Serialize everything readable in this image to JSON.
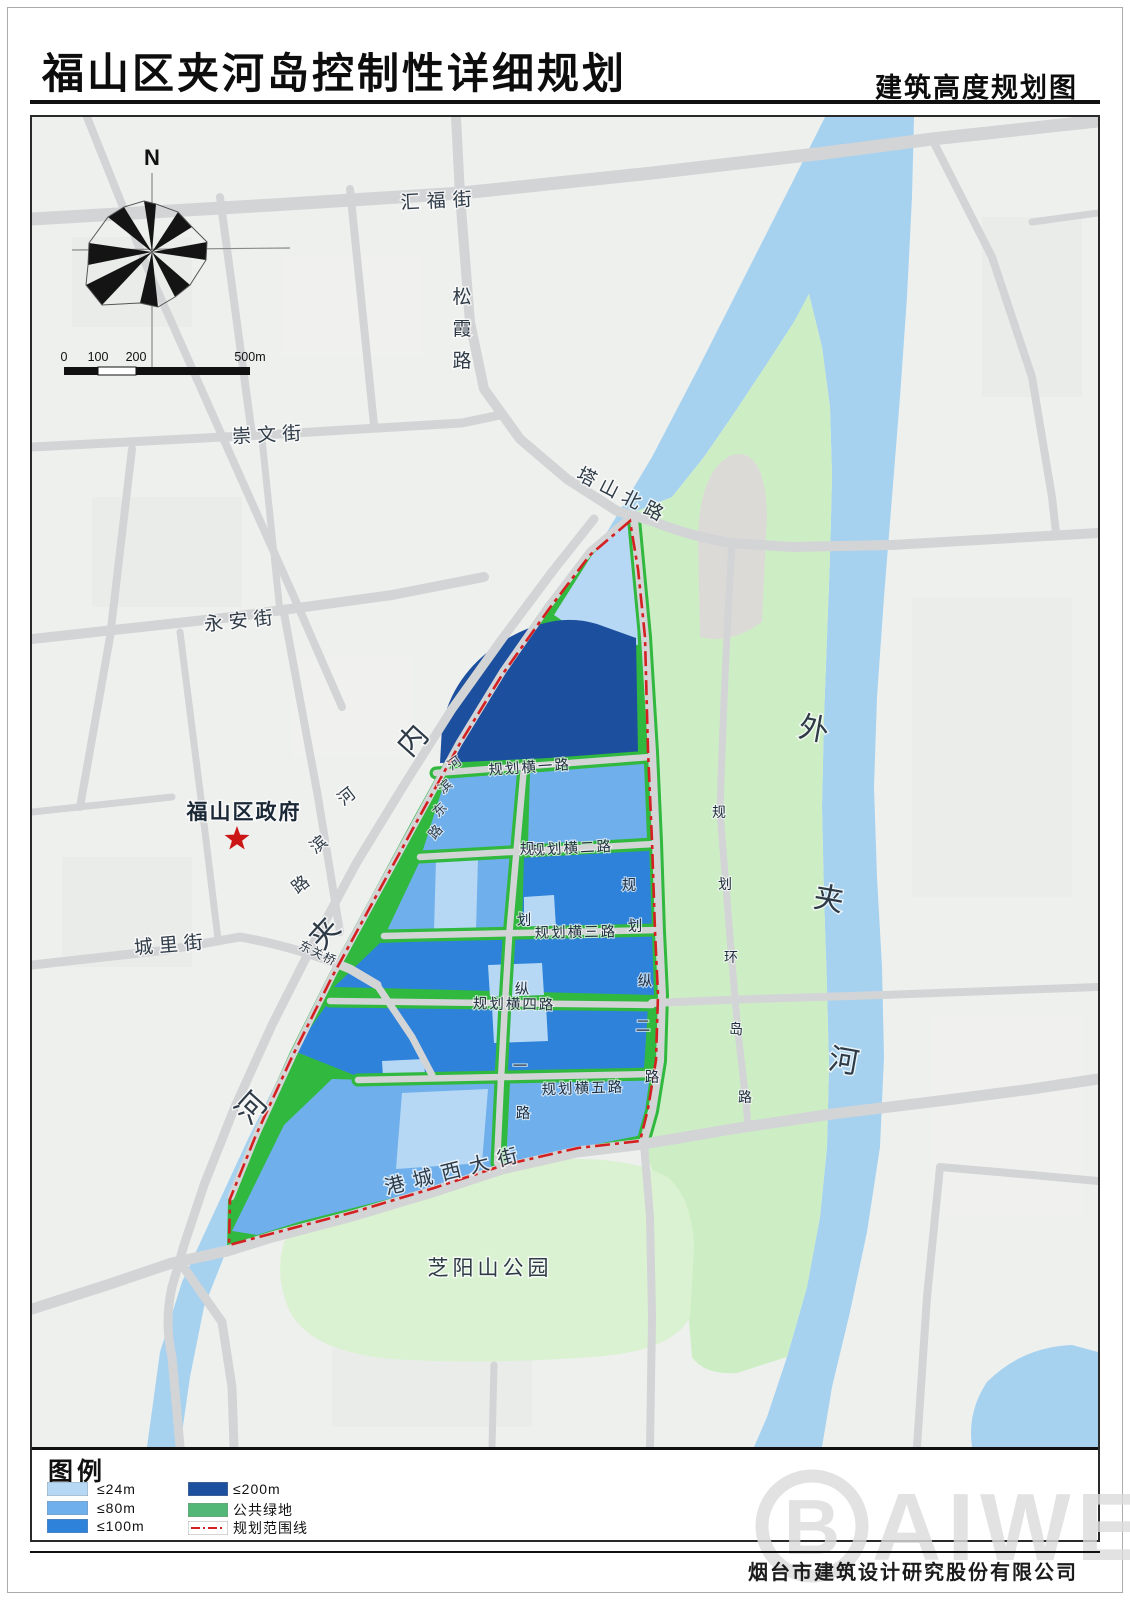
{
  "header": {
    "title": "福山区夹河岛控制性详细规划",
    "subtitle": "建筑高度规划图"
  },
  "compass": {
    "north": "N"
  },
  "scale_bar": {
    "tick0": "0",
    "tick100": "100",
    "tick200": "200",
    "tick500": "500m"
  },
  "map": {
    "colors": {
      "map_bg": "#eef0ee",
      "road": "#d3d4d6",
      "river": "#a6d2f0",
      "island_green": "#cdeec5",
      "park_green": "#daf2d2",
      "strip_green": "#31b83f",
      "h24": "#b7d8f4",
      "h80": "#6fb0ec",
      "h100": "#2e82da",
      "h200": "#1d4f9f",
      "boundary_red": "#d42020",
      "gray_blob": "#dcdad7",
      "label": "#2e3b47",
      "star": "#cc1616"
    },
    "labels": {
      "huifujie": "汇福街",
      "songxia": [
        "松",
        "霞",
        "路"
      ],
      "chongwen": "崇文街",
      "yongan": "永安街",
      "tashanbeilu": "塔山北路",
      "hebinlu": [
        "河",
        "滨",
        "路"
      ],
      "chengli": "城里街",
      "dongguanqiao": "东关桥",
      "fushan_gov": "福山区政府",
      "neijiahe": [
        "内",
        "夹",
        "河"
      ],
      "waijiahe": [
        "外",
        "夹",
        "河"
      ],
      "hebindonglu": [
        "河",
        "滨",
        "东",
        "路"
      ],
      "hengyilu": "规划横一路",
      "hengerlu": "规划横二路",
      "hengsanlu": "规划横三路",
      "hengsilu": "规划横四路",
      "hengwulu": "规划横五路",
      "zongyilu": [
        "规",
        "划",
        "纵",
        "一",
        "路"
      ],
      "zongerlu": [
        "规",
        "划",
        "纵",
        "二",
        "路"
      ],
      "huandaolu": [
        "规",
        "划",
        "环",
        "岛",
        "路"
      ],
      "gangchengxidajie": "港城西大街",
      "zhiyangshan_park": "芝阳山公园"
    }
  },
  "legend": {
    "title": "图例",
    "items": [
      {
        "label": "≤24m",
        "color": "#b7d8f4",
        "type": "swatch"
      },
      {
        "label": "≤80m",
        "color": "#6fb0ec",
        "type": "swatch"
      },
      {
        "label": "≤100m",
        "color": "#2e82da",
        "type": "swatch"
      },
      {
        "label": "≤200m",
        "color": "#1d4f9f",
        "type": "swatch"
      },
      {
        "label": "公共绿地",
        "color": "#53b877",
        "type": "swatch"
      },
      {
        "label": "规划范围线",
        "color": "#d42020",
        "type": "line"
      }
    ]
  },
  "footer": {
    "company": "烟台市建筑设计研究股份有限公司",
    "watermark": {
      "logo_letter": "B",
      "text": "AIWEI"
    }
  }
}
